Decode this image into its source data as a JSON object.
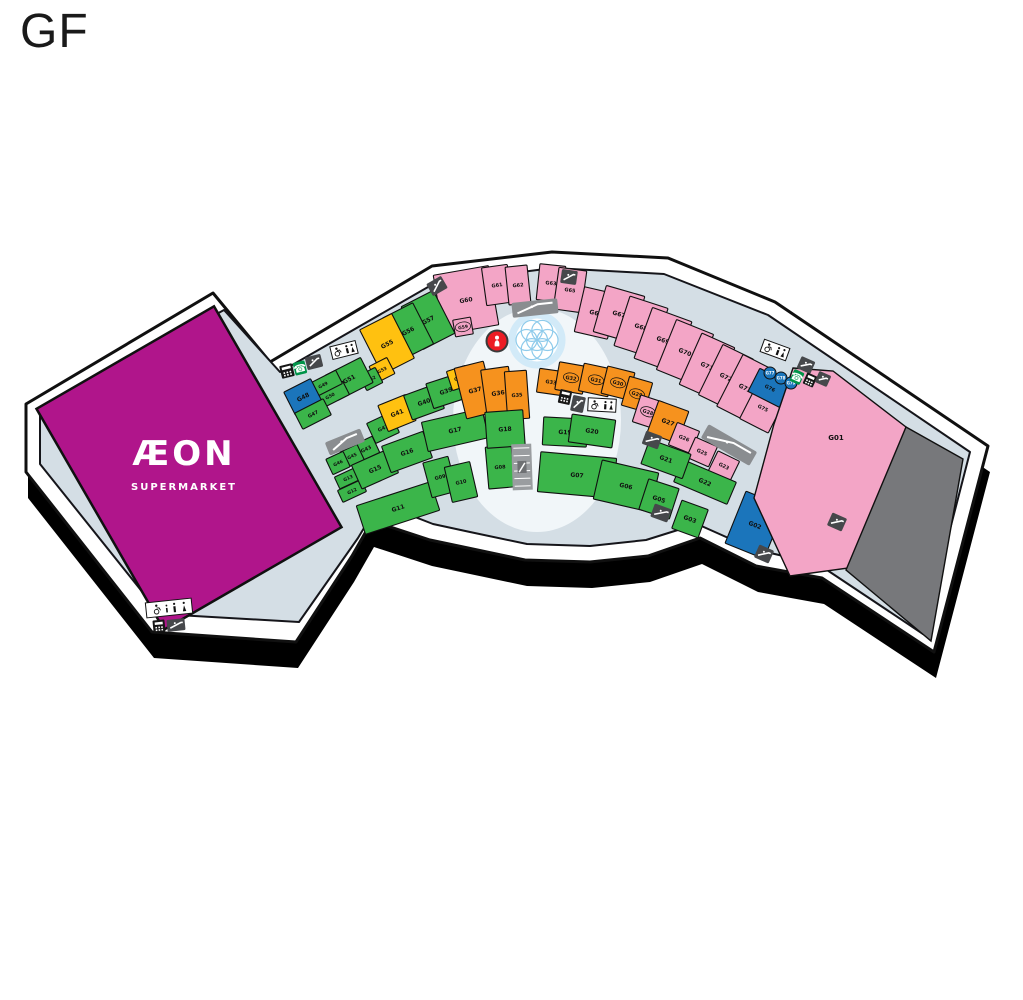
{
  "title": "GF",
  "map": {
    "colors": {
      "pink": "#F3A5C6",
      "green": "#3BB54A",
      "orange": "#F6921E",
      "yellow": "#FFC110",
      "blue": "#1B75BB",
      "magenta": "#B0158B",
      "gray": "#77787B",
      "corridor": "#D4DEE5",
      "outline": "#101010",
      "shadow": "#000000",
      "icon_dark": "#46484B",
      "icon_bar": "#8A8D90",
      "info_red": "#EC1C24",
      "fountain_blue": "#8ECBEB"
    },
    "outline": "213,293 270,362 432,266 552,252 668,258 775,302 988,446 934,652 822,578 756,566 700,538 648,556 590,562 525,560 468,548 430,540 372,521 352,556 296,642 152,632 26,472 26,404",
    "corridor_poly": "224,310 280,372 435,283 553,268 664,274 768,315 970,452 923,634 818,564 753,549 697,524 646,540 590,546 527,544 470,532 433,524 379,503 358,538 299,622 160,614 40,464 40,410",
    "shadow_offset": [
      2,
      26
    ],
    "plaza": {
      "cx": 537,
      "cy": 420,
      "rx": 84,
      "ry": 112,
      "fill": "#f1f6f9"
    },
    "fountain": {
      "cx": 537,
      "cy": 340
    },
    "anchor": {
      "id": "AEON",
      "label": "ÆON",
      "sublabel": "SUPERMARKET",
      "cx": 189,
      "cy": 468,
      "w": 205,
      "h": 255,
      "r": -30,
      "label_x": 184,
      "label_y": 465,
      "sublabel_y": 490
    },
    "units": [
      {
        "id": "G60",
        "c": "pink",
        "x": 466,
        "y": 300,
        "w": 56,
        "h": 60,
        "r": -10
      },
      {
        "id": "G61",
        "c": "pink",
        "x": 497,
        "y": 285,
        "w": 26,
        "h": 38,
        "r": -8,
        "fs": 5
      },
      {
        "id": "G62",
        "c": "pink",
        "x": 518,
        "y": 285,
        "w": 22,
        "h": 38,
        "r": -6,
        "fs": 5
      },
      {
        "id": "G59",
        "c": "pink",
        "x": 463,
        "y": 327,
        "w": 18,
        "h": 17,
        "r": -10,
        "circ": true,
        "fs": 4.5
      },
      {
        "id": "G63",
        "c": "pink",
        "x": 551,
        "y": 283,
        "w": 26,
        "h": 36,
        "r": 6,
        "fs": 5
      },
      {
        "id": "G65",
        "c": "pink",
        "x": 570,
        "y": 290,
        "w": 28,
        "h": 42,
        "r": 8,
        "fs": 5
      },
      {
        "id": "G66",
        "c": "pink",
        "x": 596,
        "y": 313,
        "w": 34,
        "h": 46,
        "r": 13
      },
      {
        "id": "G67",
        "c": "pink",
        "x": 619,
        "y": 314,
        "w": 40,
        "h": 48,
        "r": 16
      },
      {
        "id": "G68",
        "c": "pink",
        "x": 641,
        "y": 327,
        "w": 40,
        "h": 52,
        "r": 18
      },
      {
        "id": "G69",
        "c": "pink",
        "x": 663,
        "y": 340,
        "w": 42,
        "h": 54,
        "r": 20
      },
      {
        "id": "G70",
        "c": "pink",
        "x": 685,
        "y": 352,
        "w": 40,
        "h": 54,
        "r": 22
      },
      {
        "id": "G71",
        "c": "pink",
        "x": 707,
        "y": 366,
        "w": 36,
        "h": 56,
        "r": 24
      },
      {
        "id": "G72",
        "c": "pink",
        "x": 726,
        "y": 377,
        "w": 34,
        "h": 56,
        "r": 26
      },
      {
        "id": "G73",
        "c": "pink",
        "x": 745,
        "y": 388,
        "w": 34,
        "h": 58,
        "r": 27
      },
      {
        "id": "G75",
        "c": "pink",
        "x": 763,
        "y": 408,
        "w": 32,
        "h": 40,
        "r": 27,
        "fs": 5
      },
      {
        "id": "G76",
        "c": "blue",
        "x": 770,
        "y": 388,
        "w": 36,
        "h": 26,
        "r": 27,
        "fs": 5
      },
      {
        "id": "G57",
        "c": "green",
        "x": 428,
        "y": 320,
        "w": 36,
        "h": 48,
        "r": -27
      },
      {
        "id": "G56",
        "c": "green",
        "x": 408,
        "y": 331,
        "w": 34,
        "h": 46,
        "r": -27
      },
      {
        "id": "G55",
        "c": "yellow",
        "x": 387,
        "y": 344,
        "w": 36,
        "h": 50,
        "r": -27
      },
      {
        "id": "G53",
        "c": "yellow",
        "x": 382,
        "y": 370,
        "w": 20,
        "h": 18,
        "r": -27,
        "fs": 4.5
      },
      {
        "id": "G52",
        "c": "green",
        "x": 371,
        "y": 379,
        "w": 18,
        "h": 17,
        "r": -27,
        "fs": 4.5
      },
      {
        "id": "G51",
        "c": "green",
        "x": 349,
        "y": 379,
        "w": 40,
        "h": 28,
        "r": -27
      },
      {
        "id": "G50",
        "c": "green",
        "x": 330,
        "y": 396,
        "w": 36,
        "h": 15,
        "r": -27,
        "fs": 4.5
      },
      {
        "id": "G49",
        "c": "green",
        "x": 323,
        "y": 385,
        "w": 36,
        "h": 15,
        "r": -27,
        "fs": 4.5
      },
      {
        "id": "G48",
        "c": "blue",
        "x": 303,
        "y": 397,
        "w": 30,
        "h": 26,
        "r": -27
      },
      {
        "id": "G47",
        "c": "green",
        "x": 313,
        "y": 414,
        "w": 32,
        "h": 18,
        "r": -27,
        "fs": 5
      },
      {
        "id": "G42",
        "c": "green",
        "x": 383,
        "y": 428,
        "w": 26,
        "h": 22,
        "r": -25,
        "fs": 5
      },
      {
        "id": "G43",
        "c": "green",
        "x": 366,
        "y": 449,
        "w": 22,
        "h": 18,
        "r": -25,
        "fs": 5
      },
      {
        "id": "G45",
        "c": "green",
        "x": 352,
        "y": 456,
        "w": 19,
        "h": 17,
        "r": -25,
        "fs": 4.5
      },
      {
        "id": "G46",
        "c": "green",
        "x": 338,
        "y": 463,
        "w": 19,
        "h": 17,
        "r": -25,
        "fs": 4.5
      },
      {
        "id": "G13",
        "c": "green",
        "x": 348,
        "y": 478,
        "w": 24,
        "h": 13,
        "r": -25,
        "fs": 4.5
      },
      {
        "id": "G12",
        "c": "green",
        "x": 352,
        "y": 491,
        "w": 26,
        "h": 13,
        "r": -25,
        "fs": 4.5
      },
      {
        "id": "G15",
        "c": "green",
        "x": 375,
        "y": 469,
        "w": 40,
        "h": 26,
        "r": -24
      },
      {
        "id": "G16",
        "c": "green",
        "x": 407,
        "y": 452,
        "w": 44,
        "h": 28,
        "r": -20
      },
      {
        "id": "G11",
        "c": "green",
        "x": 398,
        "y": 508,
        "w": 78,
        "h": 30,
        "r": -18
      },
      {
        "id": "G09",
        "c": "green",
        "x": 440,
        "y": 477,
        "w": 26,
        "h": 36,
        "r": -15,
        "fs": 5
      },
      {
        "id": "G10",
        "c": "green",
        "x": 461,
        "y": 482,
        "w": 26,
        "h": 36,
        "r": -13,
        "fs": 5
      },
      {
        "id": "G08",
        "c": "green",
        "x": 500,
        "y": 467,
        "w": 26,
        "h": 42,
        "r": -5,
        "fs": 5
      },
      {
        "id": "G17",
        "c": "green",
        "x": 455,
        "y": 430,
        "w": 62,
        "h": 30,
        "r": -13
      },
      {
        "id": "G41",
        "c": "yellow",
        "x": 397,
        "y": 413,
        "w": 30,
        "h": 28,
        "r": -22
      },
      {
        "id": "G40",
        "c": "green",
        "x": 424,
        "y": 402,
        "w": 34,
        "h": 26,
        "r": -20
      },
      {
        "id": "G39",
        "c": "green",
        "x": 446,
        "y": 391,
        "w": 34,
        "h": 26,
        "r": -18
      },
      {
        "id": "G38",
        "c": "yellow",
        "x": 459,
        "y": 378,
        "w": 20,
        "h": 20,
        "r": -18,
        "fs": 4.5
      },
      {
        "id": "G37",
        "c": "orange",
        "x": 475,
        "y": 390,
        "w": 30,
        "h": 52,
        "r": -14
      },
      {
        "id": "G36",
        "c": "orange",
        "x": 498,
        "y": 393,
        "w": 28,
        "h": 50,
        "r": -8
      },
      {
        "id": "G35",
        "c": "orange",
        "x": 517,
        "y": 395,
        "w": 22,
        "h": 48,
        "r": -4,
        "fs": 5
      },
      {
        "id": "G18",
        "c": "green",
        "x": 505,
        "y": 429,
        "w": 38,
        "h": 36,
        "r": -4
      },
      {
        "id": "G33",
        "c": "orange",
        "x": 551,
        "y": 382,
        "w": 26,
        "h": 24,
        "r": 8,
        "fs": 5
      },
      {
        "id": "G32",
        "c": "orange",
        "x": 571,
        "y": 378,
        "w": 28,
        "h": 28,
        "r": 10,
        "circ": true,
        "fs": 5
      },
      {
        "id": "G31",
        "c": "orange",
        "x": 596,
        "y": 380,
        "w": 30,
        "h": 28,
        "r": 12,
        "circ": true,
        "fs": 5
      },
      {
        "id": "G30",
        "c": "orange",
        "x": 618,
        "y": 383,
        "w": 28,
        "h": 28,
        "r": 14,
        "circ": true,
        "fs": 5
      },
      {
        "id": "G29",
        "c": "orange",
        "x": 637,
        "y": 394,
        "w": 24,
        "h": 30,
        "r": 16,
        "circ": true,
        "fs": 5
      },
      {
        "id": "G28",
        "c": "pink",
        "x": 648,
        "y": 412,
        "w": 24,
        "h": 28,
        "r": 18,
        "circ": true,
        "fs": 5
      },
      {
        "id": "G27",
        "c": "orange",
        "x": 668,
        "y": 422,
        "w": 32,
        "h": 34,
        "r": 20
      },
      {
        "id": "G26",
        "c": "pink",
        "x": 684,
        "y": 438,
        "w": 24,
        "h": 24,
        "r": 22,
        "fs": 5
      },
      {
        "id": "G25",
        "c": "pink",
        "x": 702,
        "y": 452,
        "w": 24,
        "h": 22,
        "r": 24,
        "fs": 5
      },
      {
        "id": "G23",
        "c": "pink",
        "x": 724,
        "y": 466,
        "w": 24,
        "h": 22,
        "r": 26,
        "fs": 5
      },
      {
        "id": "G22",
        "c": "green",
        "x": 705,
        "y": 482,
        "w": 58,
        "h": 24,
        "r": 23
      },
      {
        "id": "G21",
        "c": "green",
        "x": 666,
        "y": 459,
        "w": 44,
        "h": 26,
        "r": 20
      },
      {
        "id": "G19",
        "c": "green",
        "x": 565,
        "y": 432,
        "w": 44,
        "h": 28,
        "r": 3
      },
      {
        "id": "G20",
        "c": "green",
        "x": 592,
        "y": 431,
        "w": 44,
        "h": 28,
        "r": 8
      },
      {
        "id": "G07",
        "c": "green",
        "x": 577,
        "y": 475,
        "w": 76,
        "h": 40,
        "r": 5
      },
      {
        "id": "G06",
        "c": "green",
        "x": 626,
        "y": 486,
        "w": 58,
        "h": 40,
        "r": 13
      },
      {
        "id": "G05",
        "c": "green",
        "x": 659,
        "y": 499,
        "w": 32,
        "h": 32,
        "r": 18
      },
      {
        "id": "G03",
        "c": "green",
        "x": 690,
        "y": 519,
        "w": 28,
        "h": 30,
        "r": 20
      },
      {
        "id": "G02",
        "c": "blue",
        "x": 755,
        "y": 525,
        "w": 42,
        "h": 56,
        "r": 22
      },
      {
        "id": "G01",
        "c": "pink",
        "poly": "793,368 833,371 906,427 863,566 790,576 754,498 774,424",
        "lx": 836,
        "ly": 440,
        "fs": 7
      },
      {
        "id": "",
        "c": "gray",
        "poly": "906,427 963,459 931,641 846,570",
        "lx": 0,
        "ly": 0
      }
    ],
    "kiosks": [
      {
        "id": "G77",
        "x": 770,
        "y": 373
      },
      {
        "id": "G78",
        "x": 781,
        "y": 378
      },
      {
        "id": "G79",
        "x": 791,
        "y": 383
      }
    ],
    "icons": [
      {
        "name": "escalator-icon",
        "t": "esc",
        "x": 437,
        "y": 286,
        "w": 17,
        "h": 14,
        "r": -30
      },
      {
        "name": "escalator-icon",
        "t": "esc",
        "x": 569,
        "y": 277,
        "w": 16,
        "h": 14,
        "r": 8
      },
      {
        "name": "escalator-bar-icon",
        "t": "bar",
        "x": 535,
        "y": 308,
        "w": 46,
        "h": 15,
        "r": -6
      },
      {
        "name": "information-icon",
        "t": "info",
        "x": 497,
        "y": 341,
        "w": 21,
        "h": 21,
        "r": 0
      },
      {
        "name": "atm-icon",
        "t": "atm",
        "x": 287,
        "y": 371,
        "w": 13,
        "h": 13,
        "r": -14
      },
      {
        "name": "telephone-icon",
        "t": "phone",
        "x": 300,
        "y": 368,
        "w": 12,
        "h": 13,
        "r": -14
      },
      {
        "name": "escalator-icon",
        "t": "esc",
        "x": 314,
        "y": 362,
        "w": 16,
        "h": 13,
        "r": -14
      },
      {
        "name": "accessible-restroom-icon",
        "t": "wc",
        "x": 344,
        "y": 350,
        "w": 26,
        "h": 13,
        "r": -14
      },
      {
        "name": "escalator-bar-icon",
        "t": "bar",
        "x": 345,
        "y": 442,
        "w": 38,
        "h": 14,
        "r": -22
      },
      {
        "name": "stairs-icon",
        "t": "strip",
        "x": 522,
        "y": 467,
        "w": 20,
        "h": 46,
        "r": -2
      },
      {
        "name": "atm-icon",
        "t": "atm",
        "x": 565,
        "y": 397,
        "w": 12,
        "h": 14,
        "r": 12
      },
      {
        "name": "escalator-icon",
        "t": "esc",
        "x": 578,
        "y": 404,
        "w": 13,
        "h": 16,
        "r": 12
      },
      {
        "name": "accessible-restroom-icon",
        "t": "wc",
        "x": 602,
        "y": 405,
        "w": 28,
        "h": 13,
        "r": 3
      },
      {
        "name": "escalator-icon",
        "t": "esc",
        "x": 652,
        "y": 440,
        "w": 17,
        "h": 14,
        "r": 20
      },
      {
        "name": "escalator-bar-icon",
        "t": "bar",
        "x": 729,
        "y": 445,
        "w": 56,
        "h": 16,
        "r": 30
      },
      {
        "name": "escalator-icon",
        "t": "esc",
        "x": 661,
        "y": 513,
        "w": 18,
        "h": 14,
        "r": 20
      },
      {
        "name": "accessible-restroom-icon",
        "t": "wc",
        "x": 775,
        "y": 350,
        "w": 27,
        "h": 13,
        "r": 20
      },
      {
        "name": "escalator-icon",
        "t": "esc",
        "x": 806,
        "y": 365,
        "w": 15,
        "h": 13,
        "r": 24
      },
      {
        "name": "telephone-icon",
        "t": "phone",
        "x": 797,
        "y": 377,
        "w": 11,
        "h": 13,
        "r": 24
      },
      {
        "name": "atm-icon",
        "t": "atm",
        "x": 810,
        "y": 380,
        "w": 11,
        "h": 12,
        "r": 24
      },
      {
        "name": "escalator-icon",
        "t": "esc",
        "x": 823,
        "y": 379,
        "w": 13,
        "h": 12,
        "r": 24
      },
      {
        "name": "escalator-icon",
        "t": "esc",
        "x": 837,
        "y": 522,
        "w": 16,
        "h": 14,
        "r": 24
      },
      {
        "name": "escalator-icon",
        "t": "esc",
        "x": 764,
        "y": 554,
        "w": 16,
        "h": 14,
        "r": 24
      },
      {
        "name": "family-restroom-icon",
        "t": "fam",
        "x": 169,
        "y": 608,
        "w": 46,
        "h": 15,
        "r": -6
      },
      {
        "name": "atm-icon",
        "t": "atm",
        "x": 159,
        "y": 626,
        "w": 12,
        "h": 12,
        "r": -6
      },
      {
        "name": "escalator-icon",
        "t": "esc",
        "x": 176,
        "y": 625,
        "w": 18,
        "h": 12,
        "r": -6
      }
    ]
  }
}
